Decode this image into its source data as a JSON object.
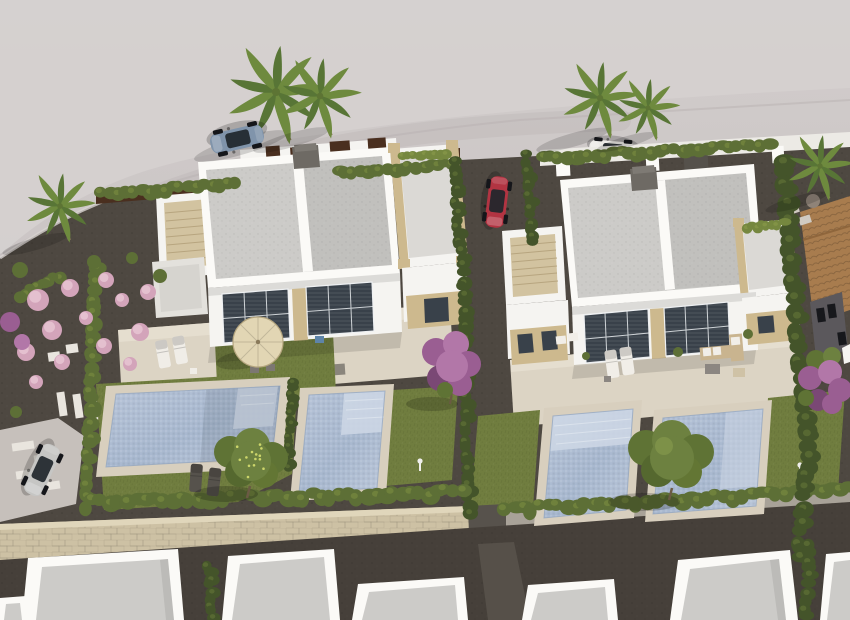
{
  "meta": {
    "title": "Aerial 3D render – new-build villas with private pools",
    "type": "architectural-visualization",
    "view": "aerial three-quarter"
  },
  "scene": {
    "caption": "Aerial 3D architectural rendering of a Mediterranean new-build development: two white duplex villas with flat grey roofs, roof solariums with stone copings and external tan staircases; four rectangular swimming pools with beige decks; lawns, dark gravel, cypress hedges, pink flowering shrubs, purple trees and palm trees; a straw parasol with dining set and sun loungers; a blue convertible, a red car, a silver car and a white car parked around; a beige stone boundary wall with a gate passage, a dark service alley and a row of neighbouring white flat roofs along the bottom; a terracotta tile-roofed house at the right edge.",
    "objects": {
      "villas": [
        {
          "id": "villa-left",
          "style": "white duplex, flat roof, right-hand roof solarium, external staircase, two large glazed facades"
        },
        {
          "id": "villa-right",
          "style": "white duplex, flat roof, right-hand roof solarium, external staircase, stone-clad ground wings"
        }
      ],
      "pools": [
        {
          "id": "pool-1",
          "note": "large pool, left unit of left villa, sun shelf on right"
        },
        {
          "id": "pool-2",
          "note": "pool of right unit of left villa, steps at top"
        },
        {
          "id": "pool-3",
          "note": "pool of left unit of right villa, wide steps at top"
        },
        {
          "id": "pool-4",
          "note": "pool of right unit of right villa"
        }
      ],
      "cars": [
        {
          "id": "car-blue-convertible",
          "color": "#8094ab",
          "location": "street top-left"
        },
        {
          "id": "car-red",
          "color": "#b23442",
          "location": "driveway between villas"
        },
        {
          "id": "car-silver",
          "color": "#c6c6c4",
          "location": "street lower-left"
        },
        {
          "id": "car-white",
          "color": "#eceae6",
          "location": "street top-centre behind boundary wall"
        }
      ],
      "vegetation": {
        "palm_trees": 6,
        "cypress_hedge_rows": 17,
        "pink_shrubs": 13,
        "purple_trees": 3,
        "green_trees": 2
      },
      "furniture": [
        "straw parasol with table and chairs",
        "white sun loungers",
        "dark poolside loungers",
        "rattan lounge set with cushions"
      ]
    },
    "palette": {
      "land": "#c9c3c3",
      "land_light": "#d6d1d0",
      "land_shade": "#bcb6b6",
      "street": "#c6c0bb",
      "curb": "#b2acaa",
      "gravel": "#4e4841",
      "gravel_light": "#5a544c",
      "grass": "#707d3f",
      "grass_dark": "#5c6a33",
      "terrace": "#dcd4c4",
      "terrace_light": "#e7e0d2",
      "deck": "#d8cfbe",
      "villa_white": "#f5f4f1",
      "villa_shade": "#e6e4df",
      "parapet": "#fbfaf7",
      "roof_gray": "#cccbc8",
      "roof_dark": "#bfbebb",
      "stone_tan": "#cdb98e",
      "stair_tan": "#d2c3a0",
      "pool_deep": "#a9b9d0",
      "pool_mid": "#b4c2d6",
      "pool_light": "#bfcbdd",
      "pool_shelf": "#ccd6e4",
      "hedge_dark": "#44542a",
      "hedge_mid": "#5d6f36",
      "hedge_light": "#75873f",
      "palm_green": "#6e8a3e",
      "palm_dark": "#587536",
      "trunk": "#8d7b5e",
      "pink": "#d3a4ba",
      "pink_light": "#e6c3d2",
      "purple": "#9a5e92",
      "purple_light": "#b277a8",
      "wall_stone": "#cdc1a4",
      "wall_stone_light": "#e0d6bb",
      "wall_gray": "#b3aca2",
      "alley": "#46403a",
      "corten": "#4a2f1f",
      "terracotta": "#a87c4e",
      "terracotta_dark": "#8a6138",
      "window": "#39414a",
      "car_blue": "#8094ab",
      "car_red": "#b23442",
      "car_silver": "#c6c6c4",
      "car_white": "#eceae6",
      "fruit": "#ccd56a",
      "umbrella": "#e2d6b4",
      "rattan": "#c9b48f",
      "cushion": "#f1eee8"
    }
  }
}
